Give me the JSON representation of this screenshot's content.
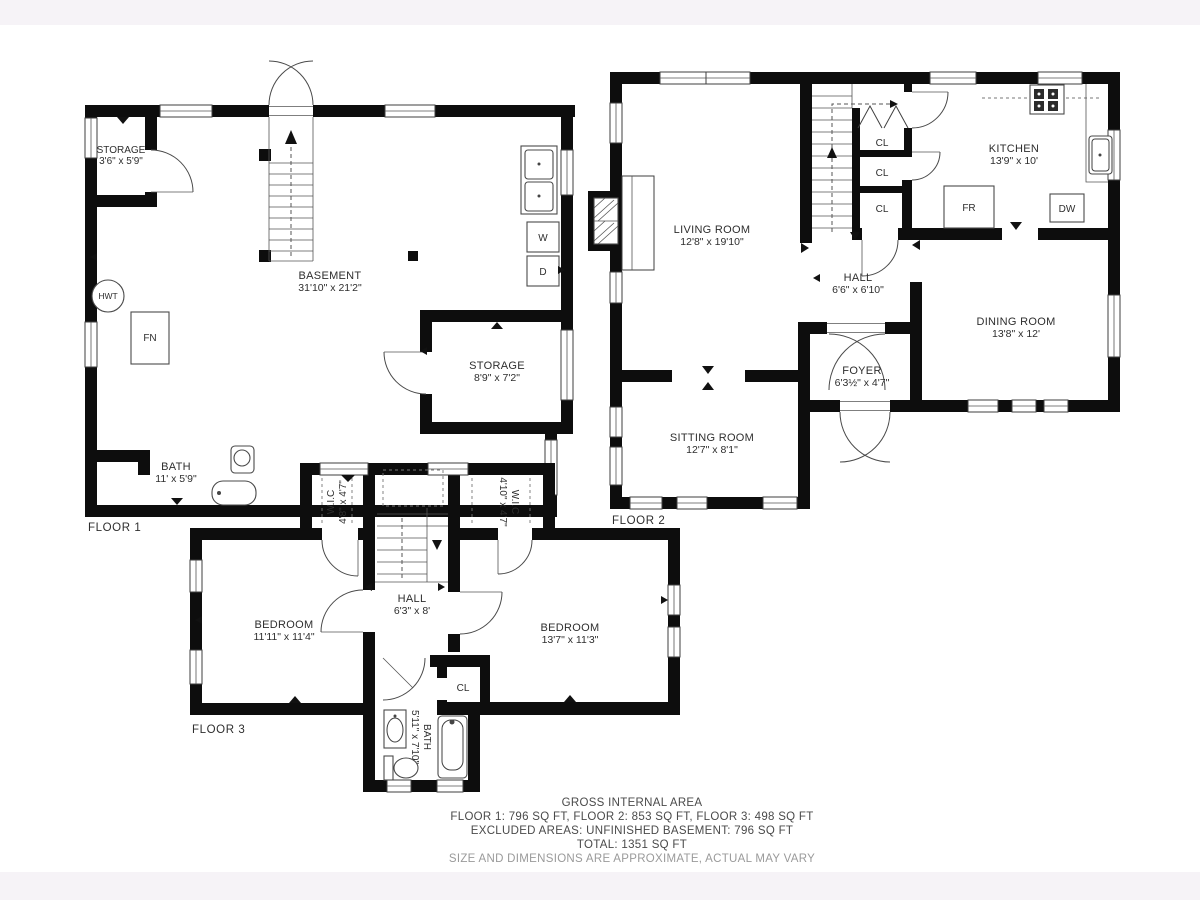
{
  "page": {
    "band_color": "#f6f3f7",
    "canvas_color": "#ffffff",
    "ink_color": "#0d0d0d"
  },
  "floor1": {
    "label": "FLOOR 1",
    "rooms": {
      "storage_small": {
        "name": "STORAGE",
        "dims": "3'6\" x 5'9\""
      },
      "basement": {
        "name": "BASEMENT",
        "dims": "31'10\" x 21'2\""
      },
      "storage": {
        "name": "STORAGE",
        "dims": "8'9\" x 7'2\""
      },
      "bath": {
        "name": "BATH",
        "dims": "11' x 5'9\""
      }
    },
    "fixtures": {
      "hwt": "HWT",
      "fn": "FN",
      "washer": "W",
      "dryer": "D"
    }
  },
  "floor2": {
    "label": "FLOOR 2",
    "rooms": {
      "living": {
        "name": "LIVING ROOM",
        "dims": "12'8\" x 19'10\""
      },
      "kitchen": {
        "name": "KITCHEN",
        "dims": "13'9\" x 10'"
      },
      "hall": {
        "name": "HALL",
        "dims": "6'6\" x 6'10\""
      },
      "dining": {
        "name": "DINING ROOM",
        "dims": "13'8\" x 12'"
      },
      "foyer": {
        "name": "FOYER",
        "dims": "6'3½\" x 4'7\""
      },
      "sitting": {
        "name": "SITTING ROOM",
        "dims": "12'7\" x 8'1\""
      }
    },
    "fixtures": {
      "cl1": "CL",
      "cl2": "CL",
      "cl3": "CL",
      "fridge": "FR",
      "dishwasher": "DW"
    }
  },
  "floor3": {
    "label": "FLOOR 3",
    "rooms": {
      "wic_left": {
        "name": "W.I.C",
        "dims": "4'8\" x 4'7\""
      },
      "wic_right": {
        "name": "W.I.C",
        "dims": "4'10\" x 4'7\""
      },
      "hall": {
        "name": "HALL",
        "dims": "6'3\" x 8'"
      },
      "bedroom_left": {
        "name": "BEDROOM",
        "dims": "11'11\" x 11'4\""
      },
      "bedroom_right": {
        "name": "BEDROOM",
        "dims": "13'7\" x 11'3\""
      },
      "bath": {
        "name": "BATH",
        "dims": "5'11\" x 7'10\""
      }
    },
    "fixtures": {
      "closet": "CL"
    }
  },
  "footer": {
    "title": "GROSS INTERNAL AREA",
    "line2": "FLOOR 1: 796 SQ FT, FLOOR 2: 853 SQ FT, FLOOR 3: 498 SQ FT",
    "line3": "EXCLUDED AREAS: UNFINISHED BASEMENT: 796 SQ FT",
    "line4": "TOTAL: 1351 SQ FT",
    "disclaimer": "SIZE AND DIMENSIONS ARE APPROXIMATE, ACTUAL MAY VARY"
  }
}
